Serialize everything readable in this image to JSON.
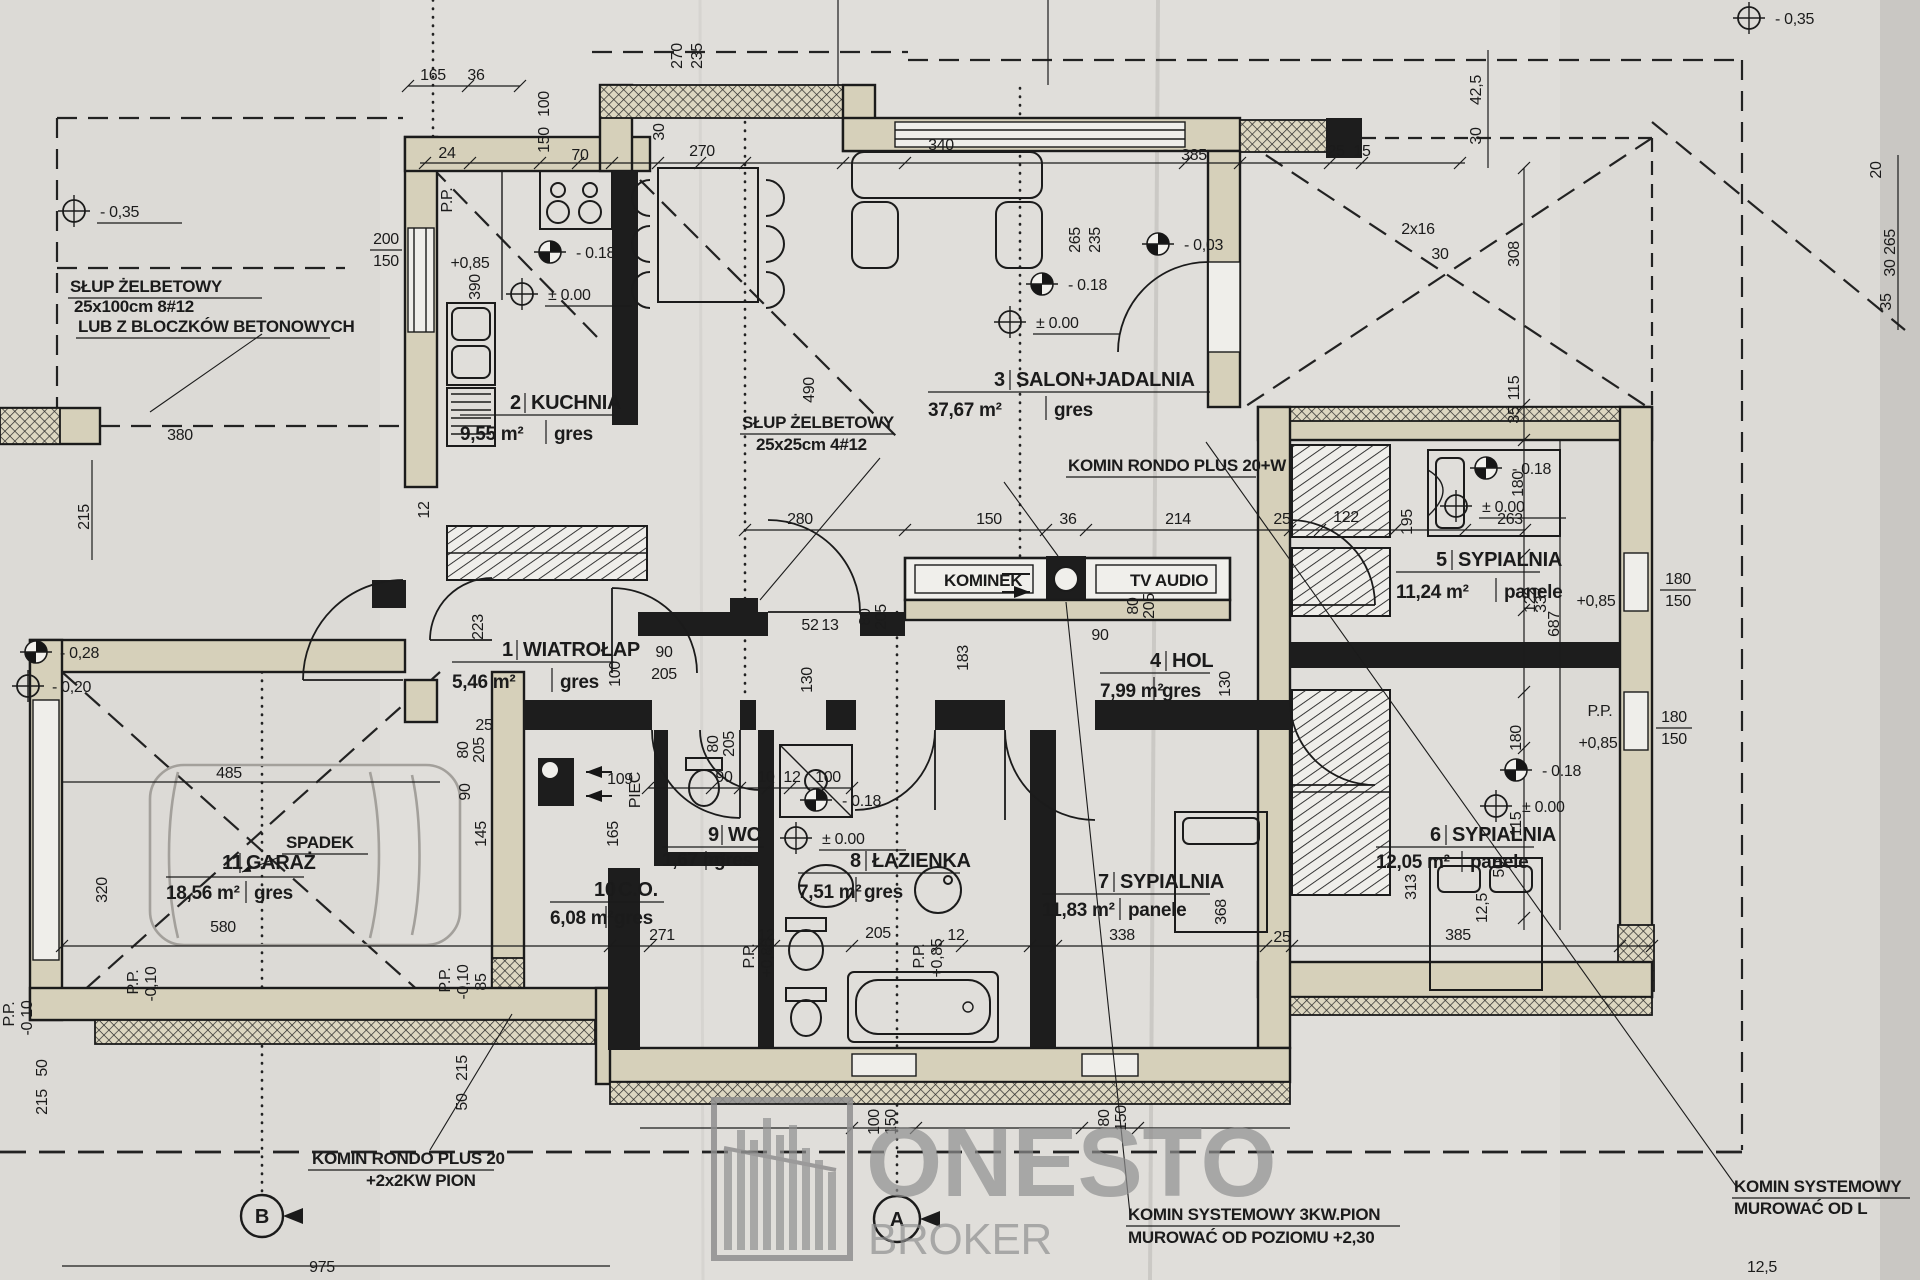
{
  "rooms": [
    {
      "num": "1",
      "name": "WIATROŁAP",
      "area": "5,46 m²",
      "floor": "gres"
    },
    {
      "num": "2",
      "name": "KUCHNIA",
      "area": "9,55 m²",
      "floor": "gres"
    },
    {
      "num": "3",
      "name": "SALON+JADALNIA",
      "area": "37,67 m²",
      "floor": "gres"
    },
    {
      "num": "4",
      "name": "HOL",
      "area": "7,99 m²",
      "floor": "gres"
    },
    {
      "num": "5",
      "name": "SYPIALNIA",
      "area": "11,24 m²",
      "floor": "panele"
    },
    {
      "num": "6",
      "name": "SYPIALNIA",
      "area": "12,05 m²",
      "floor": "panele"
    },
    {
      "num": "7",
      "name": "SYPIALNIA",
      "area": "11,83 m²",
      "floor": "panele"
    },
    {
      "num": "8",
      "name": "ŁAZIENKA",
      "area": "7,51 m²",
      "floor": "gres"
    },
    {
      "num": "9",
      "name": "WC",
      "area": "1,67 m²",
      "floor": "gres"
    },
    {
      "num": "10",
      "name": "C.O.",
      "area": "6,08 m²",
      "floor": "gres"
    },
    {
      "num": "11",
      "name": "GARAŻ",
      "area": "18,56 m²",
      "floor": "gres"
    }
  ],
  "annotations": {
    "slup_left": [
      "SŁUP ŻELBETOWY",
      "25x100cm 8#12",
      "LUB Z BLOCZKÓW BETONOWYCH"
    ],
    "slup_center": [
      "SŁUP ŻELBETOWY",
      "25x25cm 4#12"
    ],
    "komin_salon": "KOMIN RONDO PLUS 20+W",
    "kominek": "KOMINEK",
    "tv_audio": "TV AUDIO",
    "spadek": "SPADEK",
    "piec": "PIEC",
    "komin_garaz": [
      "KOMIN RONDO PLUS 20",
      "+2x2KW PION"
    ],
    "komin_dol": [
      "KOMIN SYSTEMOWY 3KW.PION",
      "MUROWAĆ OD POZIOMU +2,30"
    ],
    "komin_prawy": [
      "KOMIN SYSTEMOWY",
      "MUROWAĆ OD L"
    ]
  },
  "levels": {
    "m018": "- 0.18",
    "p000": "± 0.00",
    "p085": "+0,85",
    "m010": "-0,10",
    "pp": "P.P.",
    "m035": "- 0,35",
    "m003": "- 0,03",
    "m028": "- 0,28",
    "m020": "- 0,20"
  },
  "dims": [
    "165",
    "36",
    "100",
    "150",
    "24",
    "70",
    "270",
    "30",
    "270",
    "235",
    "340",
    "385",
    "25",
    "15",
    "265",
    "235",
    "2x16",
    "30",
    "490",
    "280",
    "150",
    "36",
    "214",
    "25",
    "122",
    "195",
    "263",
    "337",
    "223",
    "130",
    "90",
    "100",
    "205",
    "130",
    "80",
    "205",
    "52",
    "13",
    "80",
    "205",
    "80",
    "205",
    "90",
    "109",
    "90",
    "10",
    "12",
    "100",
    "165",
    "271",
    "12",
    "205",
    "12",
    "338",
    "368",
    "25",
    "385",
    "313",
    "580",
    "485",
    "320",
    "145",
    "80",
    "205",
    "90",
    "25",
    "85",
    "975",
    "183",
    "50",
    "215",
    "215",
    "50",
    "100",
    "150",
    "80",
    "150",
    "42,5",
    "30",
    "308",
    "115",
    "35",
    "180",
    "122",
    "687",
    "180",
    "115",
    "50",
    "12,5",
    "20",
    "265",
    "30",
    "35",
    "12,5",
    "380",
    "215",
    "12"
  ],
  "win": [
    "200",
    "150",
    "390",
    "180",
    "150",
    "180",
    "150"
  ],
  "axes": {
    "a": "A",
    "b": "B"
  },
  "watermark": {
    "name": "ONESTO",
    "sub": "BROKER"
  }
}
